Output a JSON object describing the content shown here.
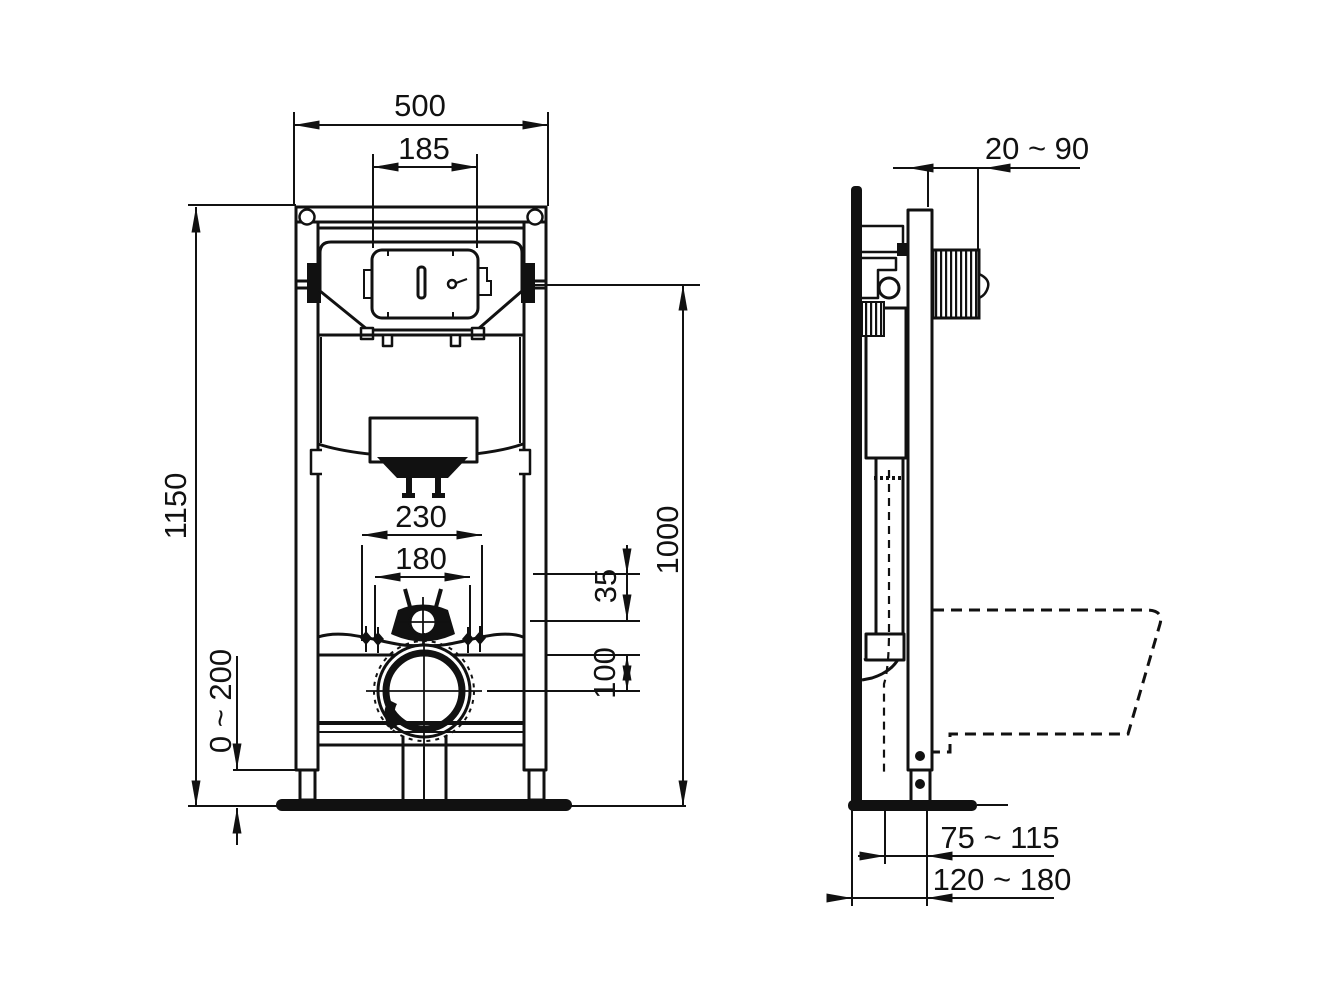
{
  "drawing": {
    "background": "#ffffff",
    "line_color": "#111111"
  },
  "front_view": {
    "dims": {
      "frame_width": "500",
      "flush_plate_width": "185",
      "frame_height": "1150",
      "outlet_height": "1000",
      "fixing_outer": "230",
      "fixing_inner": "180",
      "supply_offset": "35",
      "drain_offset": "100",
      "feet_adjust": "0 ~ 200"
    }
  },
  "side_view": {
    "dims": {
      "plate_depth": "20 ~ 90",
      "depth_min": "75 ~ 115",
      "depth_max": "120 ~ 180"
    }
  }
}
